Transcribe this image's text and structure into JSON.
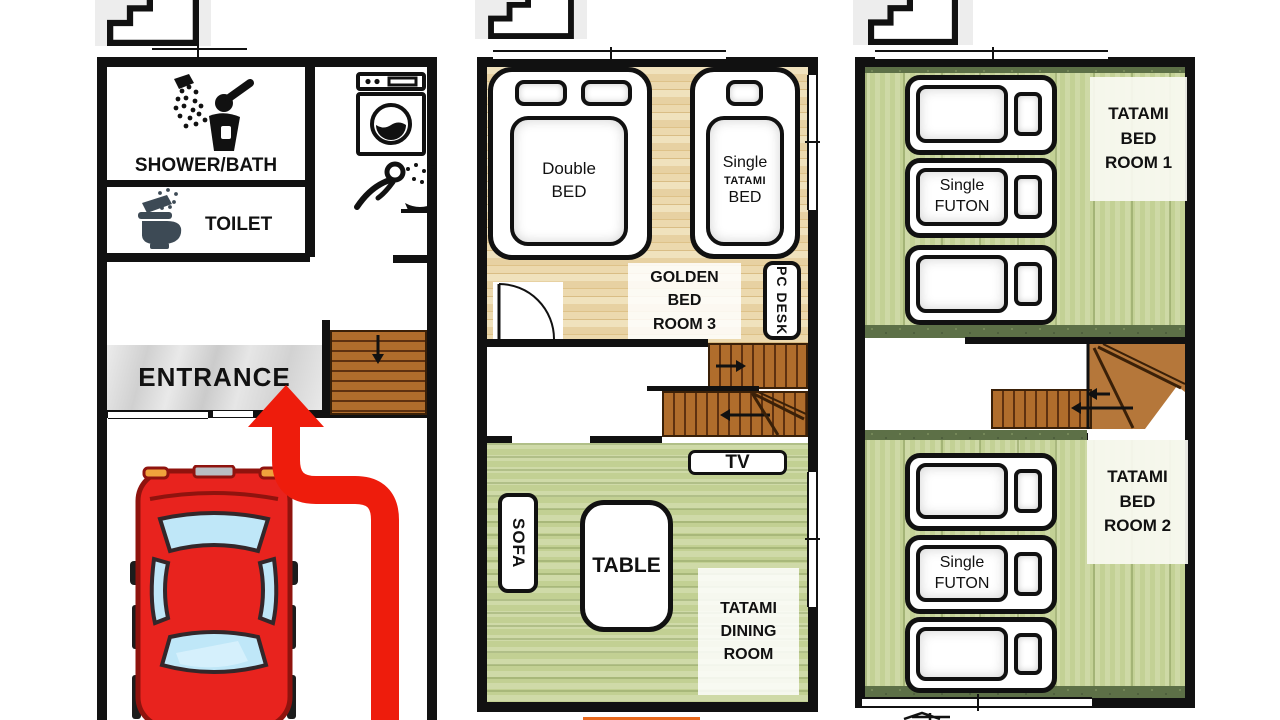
{
  "floor1": {
    "shower_bath": "SHOWER/BATH",
    "toilet": "TOILET",
    "entrance": "ENTRANCE"
  },
  "floor2": {
    "double_bed_l1": "Double",
    "double_bed_l2": "BED",
    "single_bed_l1": "Single",
    "single_bed_l2": "TATAMI",
    "single_bed_l3": "BED",
    "golden_l1": "GOLDEN",
    "golden_l2": "BED",
    "golden_l3": "ROOM 3",
    "pc_desk": "PC DESK",
    "tv": "TV",
    "sofa": "SOFA",
    "table": "TABLE",
    "dining_l1": "TATAMI",
    "dining_l2": "DINING",
    "dining_l3": "ROOM"
  },
  "floor3": {
    "room1_l1": "TATAMI",
    "room1_l2": "BED",
    "room1_l3": "ROOM 1",
    "room2_l1": "TATAMI",
    "room2_l2": "BED",
    "room2_l3": "ROOM 2",
    "futon_l1": "Single",
    "futon_l2": "FUTON"
  },
  "icons": {
    "stairs_marker": "stairs-icon",
    "shower": "shower-person-icon",
    "toilet": "toilet-icon",
    "washing_machine": "washing-machine-icon",
    "face_wash": "face-wash-icon",
    "car": "car-top-view-icon",
    "route": "red-route-arrow"
  },
  "colors": {
    "wall": "#111111",
    "tatami": "#c9d69e",
    "tatami_dark": "#5d7047",
    "wood": "#ead398",
    "stairs": "#b06d2c",
    "marble": "#dcdcdc",
    "arrow_red": "#ee1c0c",
    "car_red": "#e8231e",
    "window_blue": "#bfe7f8",
    "toilet_dark": "#3d4a55"
  }
}
